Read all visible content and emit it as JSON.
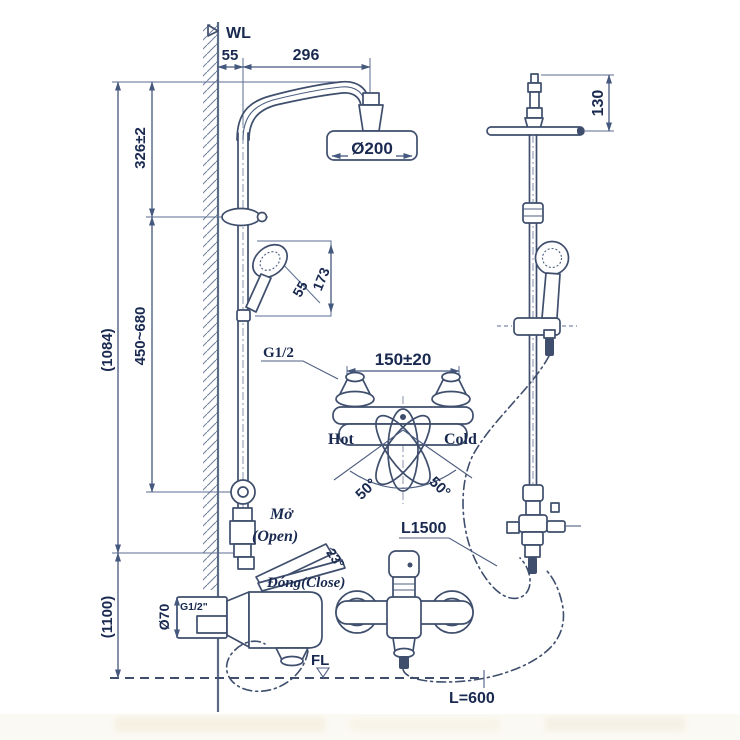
{
  "drawing_title": "shower-column-installation-diagram",
  "colors": {
    "line": "#3e4e6c",
    "dimension": "#45587d",
    "text": "#19294f",
    "wall": "#5a6b85",
    "background": "#ffffff"
  },
  "labels": {
    "wl": "WL",
    "fl": "FL",
    "open_vi": "Mở",
    "open_en": "(Open)",
    "close": "Đóng(Close)",
    "hot": "Hot",
    "cold": "Cold",
    "g_half": "G1/2",
    "g_half_inch": "G1/2\"",
    "hose_length": "L1500",
    "spout_hose_length": "L=600"
  },
  "dims": {
    "wall_offset": "55",
    "arm_reach": "296",
    "head_dia": "Ø200",
    "head_height": "130",
    "arm_drop": "326±2",
    "slide_range": "450~680",
    "bar_height": "(1084)",
    "mixer_height": "(1100)",
    "hand_shower_len": "173",
    "hand_shower_dia": "55",
    "inlet_pitch": "150±20",
    "swing_left": "50°",
    "swing_right": "50°",
    "lever_angle": "23°",
    "flange_dia": "Ø70"
  }
}
